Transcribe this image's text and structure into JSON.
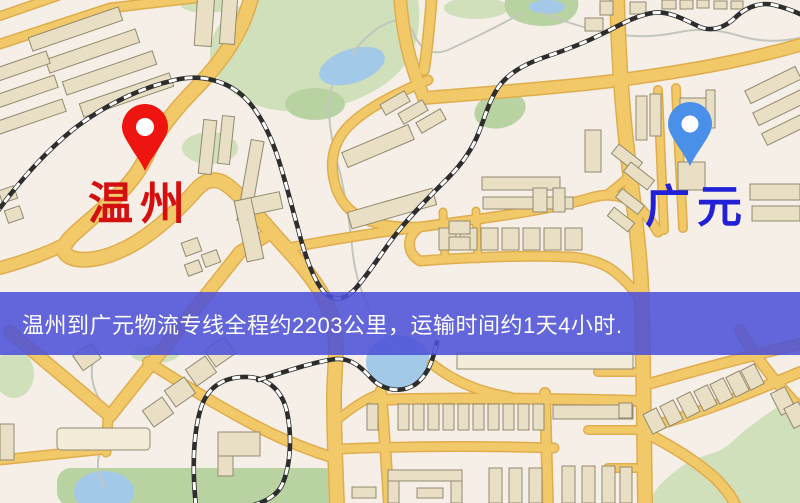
{
  "route": {
    "origin": "温州",
    "destination": "广元",
    "distance_text": "约2203公里",
    "duration_text": "约1天4小时"
  },
  "markers": {
    "origin": {
      "label": "温州",
      "icon": "map-pin-icon",
      "label_color": "#d40f0f",
      "pin_color": "#ee1410"
    },
    "destination": {
      "label": "广元",
      "icon": "map-pin-icon",
      "label_color": "#2120d6",
      "pin_color": "#4a8fe8"
    }
  },
  "banner": {
    "text": "温州到广元物流专线全程约2203公里，运输时间约1天4小时.",
    "bg_color": "#4d52d8",
    "text_color": "#ffffff"
  },
  "theme": {
    "map_bg": "#f5efe8",
    "road_fill": "#f2c969",
    "road_edge": "#dfad4e",
    "building_fill": "#e9dfc4",
    "building_stroke": "#93896f",
    "building_light": "#f2ecd8",
    "park_green": "#cfe0ba",
    "park_dark": "#b9d2a2",
    "water_blue": "#a3c9e8",
    "rail_dark": "#2d2d2d",
    "stream_gray": "#c3c6bd",
    "banner_bg": "#4d52d8",
    "banner_text": "#ffffff",
    "origin_label": "#d40f0f",
    "origin_pin": "#ee1410",
    "dest_label": "#2120d6",
    "dest_pin": "#4a8fe8"
  }
}
